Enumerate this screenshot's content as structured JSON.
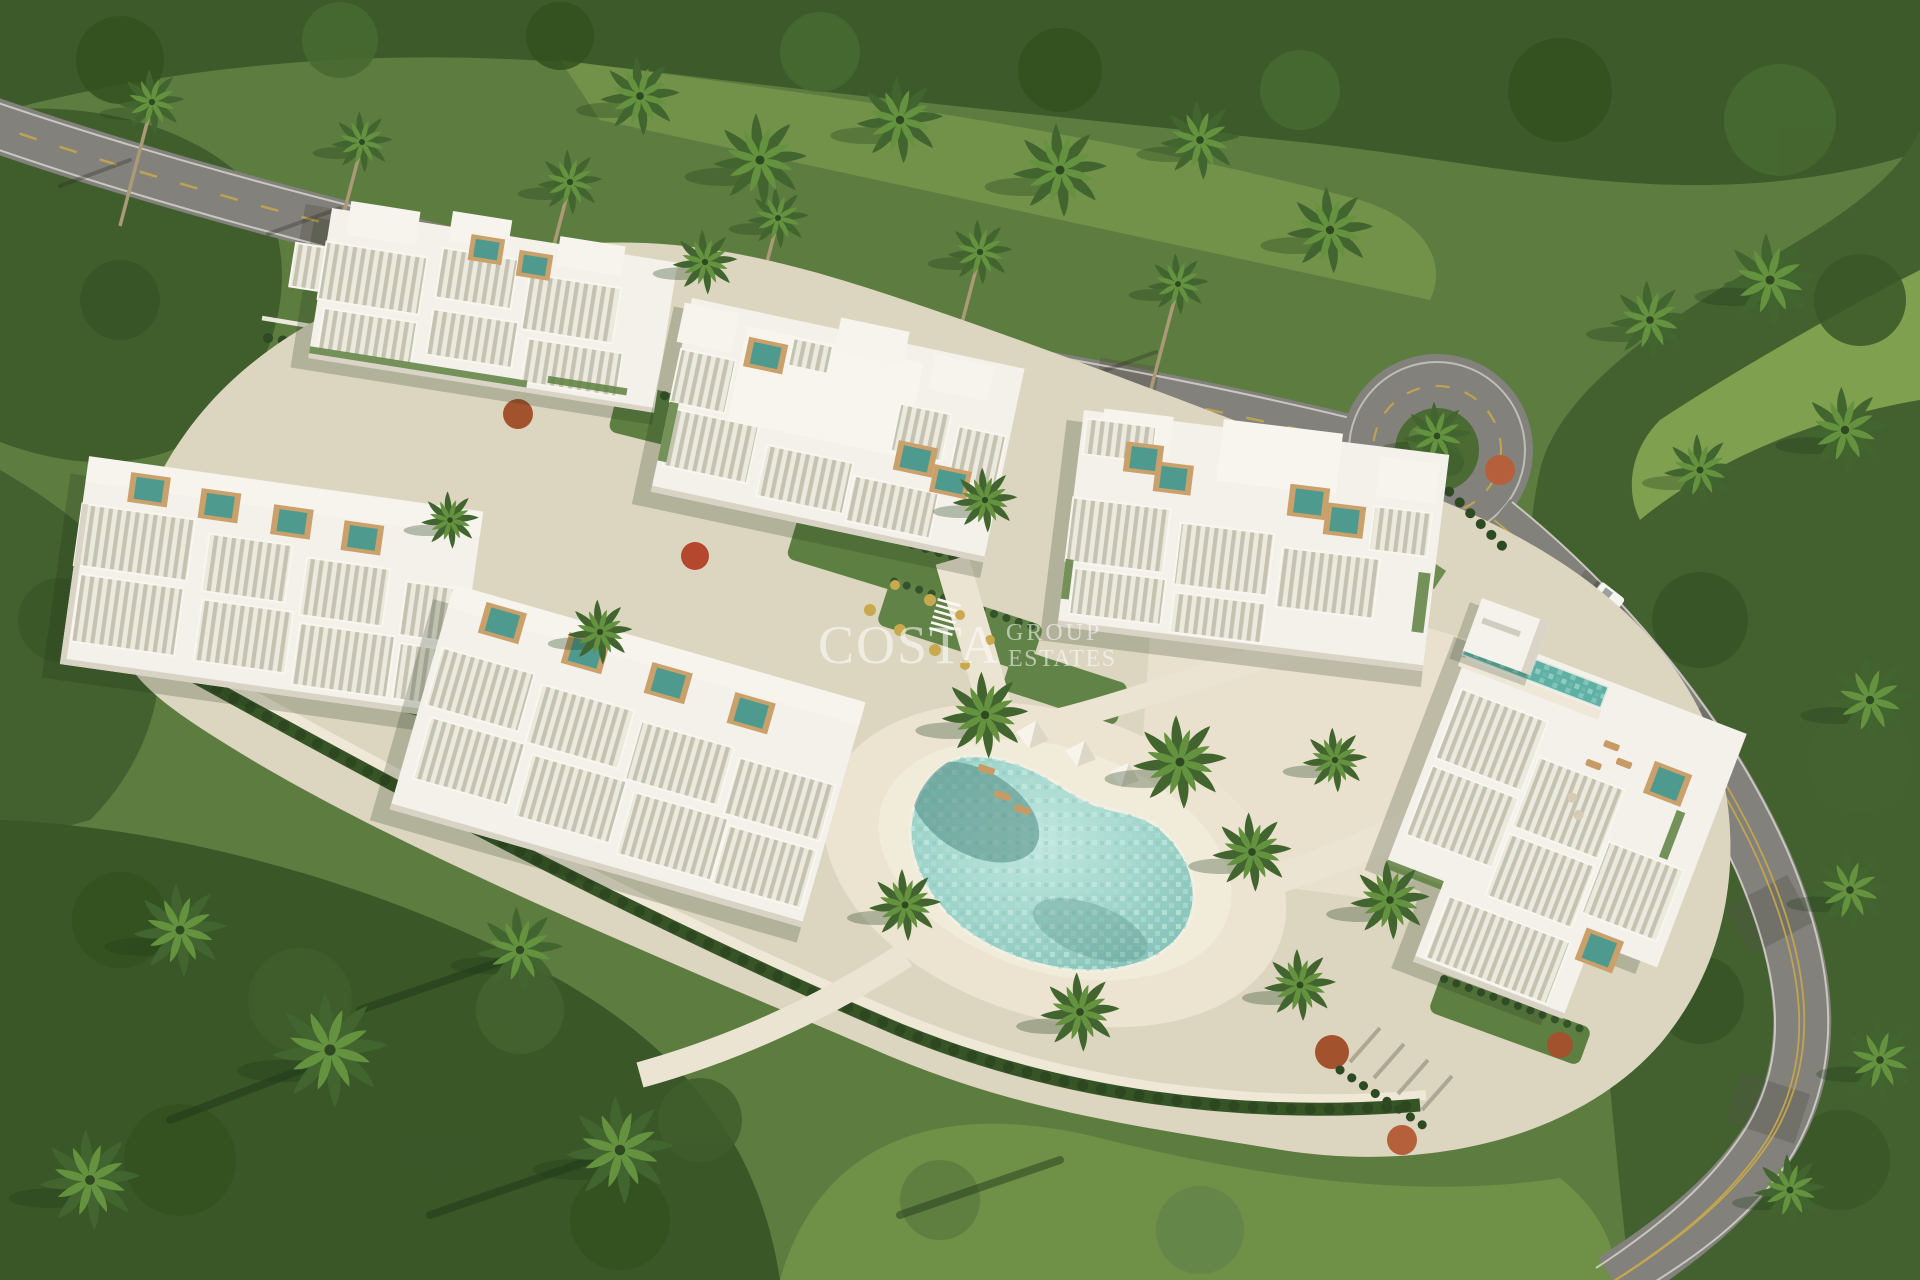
{
  "watermark": {
    "brand": "COSTA",
    "line1": "GROUP",
    "line2": "ESTATES"
  },
  "scene": {
    "description": "Aerial render of a gated residential community: six white modern villa blocks with louvered pergola roofs and rooftop plunge pools, terraced hedge gardens, a central lagoon-style swimming pool with cabanas, palm-lined avenue at top, a roundabout and a curving road on the right, surrounded by dense tropical jungle and lawns.",
    "building_count": 6,
    "rooftop_pools": true,
    "central_lagoon_pool": true,
    "cabana_count": 3,
    "roundabout": true,
    "vehicles": [
      {
        "type": "car",
        "color": "white",
        "location": "east road near entrance"
      }
    ]
  },
  "palette": {
    "jungle_dark": "#33511f",
    "jungle_mid": "#42612e",
    "lawn_light": "#74944a",
    "asphalt": "#82817b",
    "marking_yellow": "#c9a84c",
    "building_white": "#f3f1e9",
    "louver_shade": "#c6c2b2",
    "pool_teal": "#4f9a8e",
    "lagoon_teal": "#9fd4ca",
    "deck_sand": "#ece4d0",
    "hedge_green": "#375427",
    "accent_rust": "#a3522e",
    "watermark_white": "#ffffff"
  }
}
